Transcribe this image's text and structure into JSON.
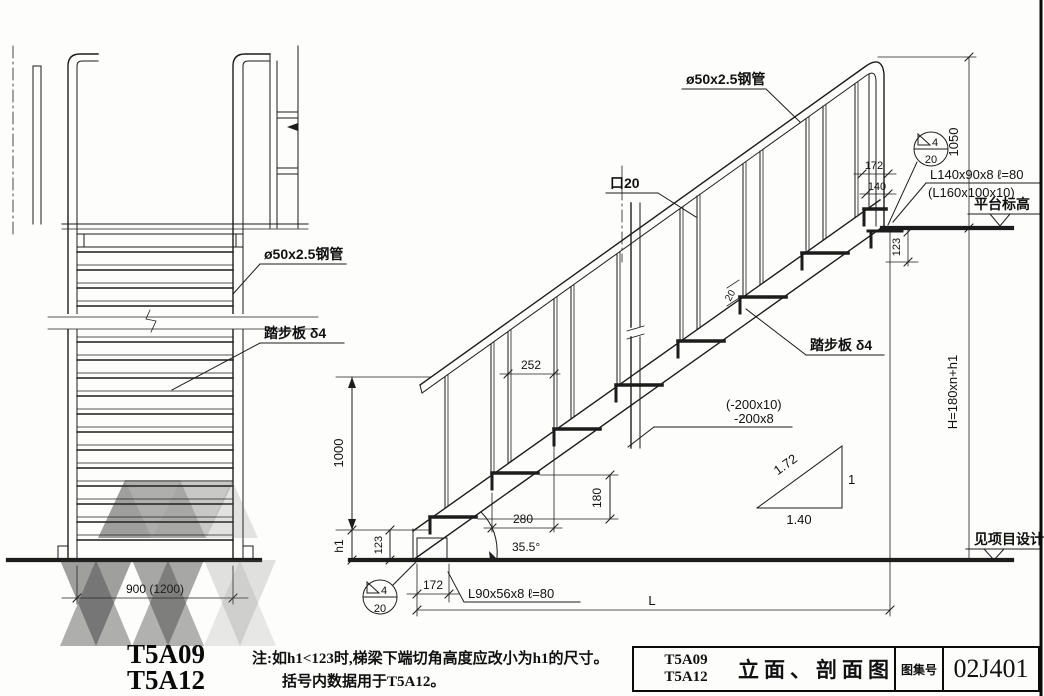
{
  "left_view": {
    "pipe_label": "ø50x2.5钢管",
    "tread_label": "踏步板 δ4",
    "width_dim": "900 (1200)",
    "code_line1": "T5A09",
    "code_line2": "T5A12"
  },
  "section": {
    "pipe_label": "ø50x2.5钢管",
    "square_bar_label": "口20",
    "bar_width": "20",
    "dim_1050": "1050",
    "dim_172_top": "172",
    "dim_140": "140",
    "weld_size": "4",
    "weld_length": "20",
    "angle_top": "L140x90x8  ℓ=80",
    "angle_top_alt": "(L160x100x10)",
    "platform_label": "平台标高",
    "dim_123_top": "123",
    "tread_label": "踏步板 δ4",
    "stringer_plate": "(-200x10)",
    "stringer_plate2": "-200x8",
    "dim_252": "252",
    "dim_1000": "1000",
    "dim_h1": "h1",
    "dim_123_bottom": "123",
    "dim_180": "180",
    "dim_280": "280",
    "angle_deg": "35.5°",
    "weld_size_b": "4",
    "weld_length_b": "20",
    "dim_172_bottom": "172",
    "angle_bottom": "L90x56x8  ℓ=80",
    "dim_span": "L",
    "height_formula": "H=180xn+h1",
    "slope_hyp": "1.72",
    "slope_rise": "1",
    "slope_run": "1.40",
    "project_note": "见项目设计"
  },
  "note": {
    "line1": "注:如h1<123时,梯梁下端切角高度应改小为h1的尺寸。",
    "line2": "括号内数据用于T5A12。"
  },
  "title_block": {
    "code1": "T5A09",
    "code2": "T5A12",
    "title": "立面、剖面图",
    "atlas_label": "图集号",
    "atlas_no": "02J401"
  }
}
